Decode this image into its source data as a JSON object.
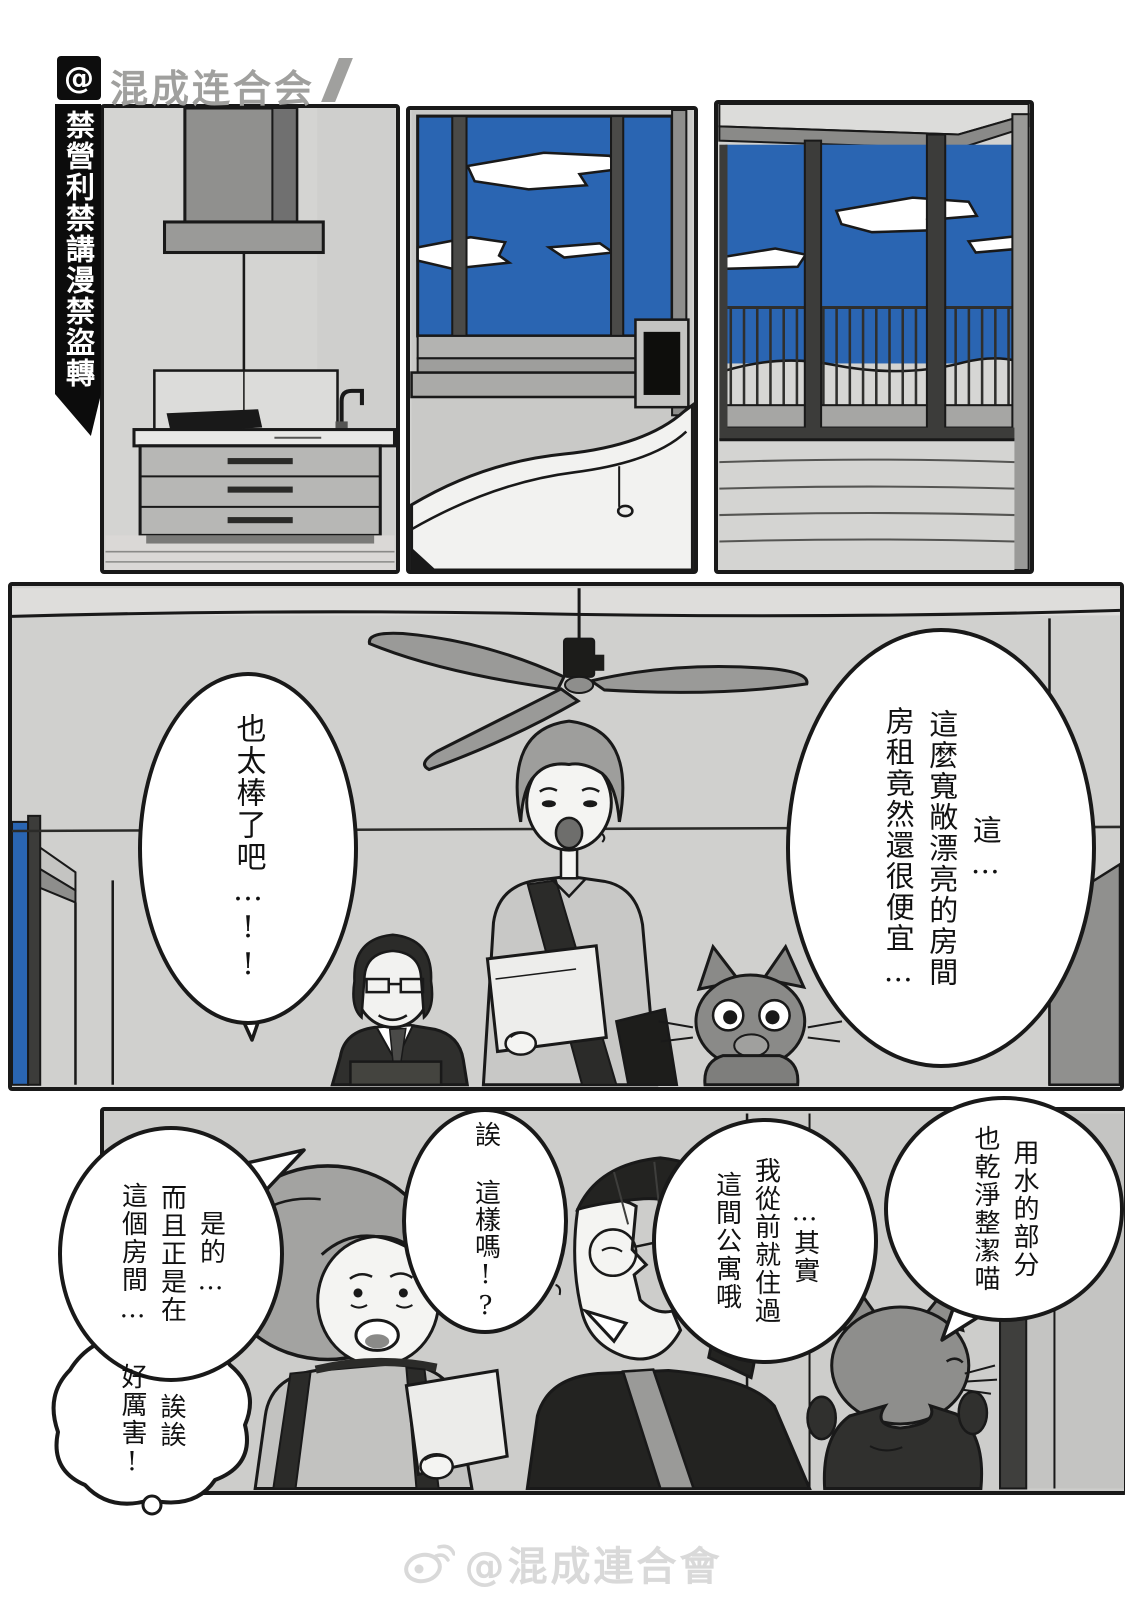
{
  "header": {
    "at_badge": "@",
    "logo_text": "混成连合会",
    "ban_banner": "禁營利禁講漫禁盜轉"
  },
  "bubbles": {
    "amazing": "也太棒了吧…!!",
    "cheap": "這…\n這麼寬敞漂亮的房間\n房租竟然還很便宜…",
    "water": "用水的部分\n也乾淨整潔喵",
    "actually": "…其實\n我從前就住過\n這間公寓哦",
    "eh": "誒 這樣嗎!?",
    "yes": "是的…\n而且正是在\n這個房間…",
    "wow": "誒誒\n好厲害!"
  },
  "footer": {
    "watermark": "@混成連合會"
  },
  "colors": {
    "sky_blue": "#2a65b2",
    "wall_gray": "#d2d2d0",
    "ink": "#191919"
  }
}
